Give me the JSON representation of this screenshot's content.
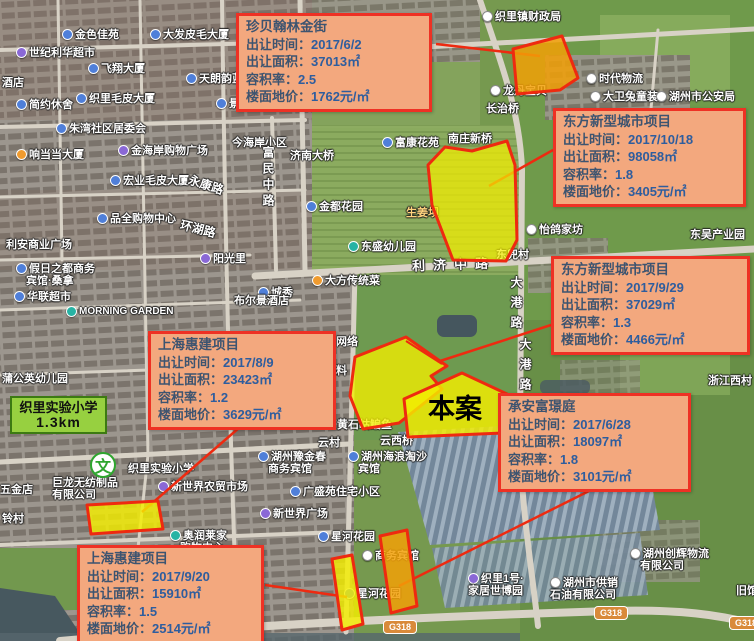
{
  "site_label": "本案",
  "school_badge": {
    "name": "织里实验小学",
    "distance": "1.3km"
  },
  "school_poi": {
    "glyph": "文"
  },
  "colors": {
    "callout_bg": "#f3a87e",
    "callout_border": "#ee3124",
    "callout_text": "#3d5470",
    "callout_value": "#2e5d9e",
    "parcel_yellow": "#f4ee00",
    "parcel_orange": "#f2a007",
    "parcel_stroke": "#ee2a10",
    "school_badge_bg": "#97d040"
  },
  "callouts": [
    {
      "name": "珍贝翰林金街",
      "x": 236,
      "y": 13,
      "w": 196,
      "h": 93,
      "rows": [
        {
          "label": "出让时间：",
          "value": "2017/6/2"
        },
        {
          "label": "出让面积：",
          "value": "37013㎡"
        },
        {
          "label": "容积率：",
          "value": "2.5"
        },
        {
          "label": "楼面地价：",
          "value": "1762元/㎡"
        }
      ]
    },
    {
      "name": "东方新型城市项目",
      "x": 553,
      "y": 108,
      "w": 193,
      "h": 95,
      "rows": [
        {
          "label": "出让时间：",
          "value": "2017/10/18"
        },
        {
          "label": "出让面积：",
          "value": "98058㎡"
        },
        {
          "label": "容积率：",
          "value": "1.8"
        },
        {
          "label": "楼面地价：",
          "value": "3405元/㎡"
        }
      ]
    },
    {
      "name": "东方新型城市项目",
      "x": 551,
      "y": 256,
      "w": 199,
      "h": 99,
      "rows": [
        {
          "label": "出让时间：",
          "value": "2017/9/29"
        },
        {
          "label": "出让面积：",
          "value": "37029㎡"
        },
        {
          "label": "容积率：",
          "value": "1.3"
        },
        {
          "label": "楼面地价：",
          "value": "4466元/㎡"
        }
      ]
    },
    {
      "name": "上海惠建项目",
      "x": 148,
      "y": 331,
      "w": 188,
      "h": 96,
      "rows": [
        {
          "label": "出让时间：",
          "value": "2017/8/9"
        },
        {
          "label": "出让面积：",
          "value": "23423㎡"
        },
        {
          "label": "容积率：",
          "value": "1.2"
        },
        {
          "label": "楼面地价：",
          "value": "3629元/㎡"
        }
      ]
    },
    {
      "name": "承安富璟庭",
      "x": 498,
      "y": 393,
      "w": 193,
      "h": 98,
      "rows": [
        {
          "label": "出让时间：",
          "value": "2017/6/28"
        },
        {
          "label": "出让面积：",
          "value": "18097㎡"
        },
        {
          "label": "容积率：",
          "value": "1.8"
        },
        {
          "label": "楼面地价：",
          "value": "3101元/㎡"
        }
      ]
    },
    {
      "name": "上海惠建项目",
      "x": 77,
      "y": 545,
      "w": 187,
      "h": 95,
      "rows": [
        {
          "label": "出让时间：",
          "value": "2017/9/20"
        },
        {
          "label": "出让面积：",
          "value": "15910㎡"
        },
        {
          "label": "容积率：",
          "value": "1.5"
        },
        {
          "label": "楼面地价：",
          "value": "2514元/㎡"
        }
      ]
    }
  ],
  "road_badges": [
    {
      "t": "G318",
      "x": 383,
      "y": 620
    },
    {
      "t": "G318",
      "x": 594,
      "y": 606
    },
    {
      "t": "G318",
      "x": 729,
      "y": 616
    }
  ],
  "map_labels": [
    {
      "t": "金色佳苑",
      "x": 62,
      "y": 26,
      "icon": "blue"
    },
    {
      "t": "大发皮毛大厦",
      "x": 150,
      "y": 26,
      "icon": "blue"
    },
    {
      "t": "世纪利华超市",
      "x": 16,
      "y": 44,
      "icon": "purple"
    },
    {
      "t": "飞翔大厦",
      "x": 88,
      "y": 60,
      "icon": "blue"
    },
    {
      "t": "天朗韵蓝城",
      "x": 186,
      "y": 70,
      "icon": "blue"
    },
    {
      "t": "酒店",
      "x": 2,
      "y": 74
    },
    {
      "t": "织里毛皮大厦",
      "x": 76,
      "y": 90,
      "icon": "blue"
    },
    {
      "t": "简约休舍",
      "x": 16,
      "y": 96,
      "icon": "blue"
    },
    {
      "t": "景",
      "x": 216,
      "y": 95,
      "icon": "blue"
    },
    {
      "t": "朱湾社区居委会",
      "x": 56,
      "y": 120,
      "icon": "blue"
    },
    {
      "t": "金海岸购物广场",
      "x": 118,
      "y": 142,
      "icon": "purple"
    },
    {
      "t": "今海岸小区",
      "x": 232,
      "y": 134
    },
    {
      "t": "响当当大厦",
      "x": 16,
      "y": 146,
      "icon": "orange"
    },
    {
      "t": "宏业毛皮大厦",
      "x": 110,
      "y": 172,
      "icon": "blue"
    },
    {
      "t": "永康路",
      "x": 188,
      "y": 176,
      "rot": 18,
      "sz": 12
    },
    {
      "t": "品全购物中心",
      "x": 97,
      "y": 210,
      "icon": "blue"
    },
    {
      "t": "环湖路",
      "x": 180,
      "y": 220,
      "rot": 14,
      "sz": 12
    },
    {
      "t": "利安商业广场",
      "x": 6,
      "y": 236
    },
    {
      "t": "阳光里",
      "x": 200,
      "y": 250,
      "icon": "purple"
    },
    {
      "t": "假日之都商务",
      "x": 16,
      "y": 260,
      "icon": "blue"
    },
    {
      "t": "宾馆·桑拿",
      "x": 26,
      "y": 272
    },
    {
      "t": "华联超市",
      "x": 14,
      "y": 288,
      "icon": "blue"
    },
    {
      "t": "MORNING GARDEN",
      "x": 66,
      "y": 306,
      "icon": "teal",
      "sz": 10
    },
    {
      "t": "蒲公英幼儿园",
      "x": 2,
      "y": 370
    },
    {
      "t": "济南大桥",
      "x": 290,
      "y": 147
    },
    {
      "t": "富民中路",
      "x": 260,
      "y": 146,
      "v": 1,
      "ls": 4,
      "sz": 12
    },
    {
      "t": "富康花苑",
      "x": 382,
      "y": 134,
      "icon": "blue"
    },
    {
      "t": "南庄新桥",
      "x": 448,
      "y": 130
    },
    {
      "t": "金都花园",
      "x": 306,
      "y": 198,
      "icon": "blue"
    },
    {
      "t": "生姜坝",
      "x": 406,
      "y": 204,
      "color": "#ffd37e"
    },
    {
      "t": "东盛幼儿园",
      "x": 348,
      "y": 238,
      "icon": "teal"
    },
    {
      "t": "利济中路",
      "x": 412,
      "y": 254,
      "ls": 8,
      "sz": 13,
      "rot": -2
    },
    {
      "t": "大方传统菜",
      "x": 312,
      "y": 272,
      "icon": "orange"
    },
    {
      "t": "城秀",
      "x": 258,
      "y": 284,
      "icon": "blue"
    },
    {
      "t": "布尔景酒店",
      "x": 234,
      "y": 292
    },
    {
      "t": "网络",
      "x": 336,
      "y": 333
    },
    {
      "t": "料",
      "x": 336,
      "y": 362
    },
    {
      "t": "黄石岵鳊鱼",
      "x": 337,
      "y": 416
    },
    {
      "t": "云村",
      "x": 318,
      "y": 434
    },
    {
      "t": "云西桥",
      "x": 380,
      "y": 432
    },
    {
      "t": "湖州豫金春",
      "x": 258,
      "y": 448,
      "icon": "blue"
    },
    {
      "t": "商务宾馆",
      "x": 268,
      "y": 460
    },
    {
      "t": "湖州海浪淘沙",
      "x": 348,
      "y": 448,
      "icon": "blue"
    },
    {
      "t": "宾馆",
      "x": 358,
      "y": 460
    },
    {
      "t": "广盛苑住宅小区",
      "x": 290,
      "y": 483,
      "icon": "blue"
    },
    {
      "t": "新世界广场",
      "x": 260,
      "y": 505,
      "icon": "purple"
    },
    {
      "t": "星河花园",
      "x": 318,
      "y": 528,
      "icon": "blue"
    },
    {
      "t": "商务宾馆",
      "x": 362,
      "y": 547,
      "icon": "white"
    },
    {
      "t": "星河花园",
      "x": 344,
      "y": 585,
      "icon": "blue"
    },
    {
      "t": "织里1号·",
      "x": 468,
      "y": 570,
      "icon": "purple"
    },
    {
      "t": "家居世博园",
      "x": 468,
      "y": 582
    },
    {
      "t": "奥润莱家",
      "x": 170,
      "y": 527,
      "icon": "teal"
    },
    {
      "t": "购物中心",
      "x": 180,
      "y": 539
    },
    {
      "t": "新世界农贸市场",
      "x": 158,
      "y": 478,
      "icon": "purple"
    },
    {
      "t": "织里实验小学",
      "x": 128,
      "y": 460
    },
    {
      "t": "巨龙无纺制品",
      "x": 52,
      "y": 474
    },
    {
      "t": "有限公司",
      "x": 52,
      "y": 486
    },
    {
      "t": "五金店",
      "x": 0,
      "y": 481
    },
    {
      "t": "铃村",
      "x": 2,
      "y": 510
    },
    {
      "t": "织里镇财政局",
      "x": 482,
      "y": 8,
      "icon": "white"
    },
    {
      "t": "时代物流",
      "x": 586,
      "y": 70,
      "icon": "white"
    },
    {
      "t": "龙丹宝贝",
      "x": 490,
      "y": 82,
      "icon": "white"
    },
    {
      "t": "大卫兔童装",
      "x": 590,
      "y": 88,
      "icon": "white"
    },
    {
      "t": "湖州市公安局",
      "x": 656,
      "y": 88,
      "icon": "white"
    },
    {
      "t": "长治桥",
      "x": 486,
      "y": 100
    },
    {
      "t": "怡鸽家坊",
      "x": 526,
      "y": 221,
      "icon": "white"
    },
    {
      "t": "东吴产业园",
      "x": 690,
      "y": 226
    },
    {
      "t": "东兜村",
      "x": 496,
      "y": 246
    },
    {
      "t": "大港路",
      "x": 508,
      "y": 276,
      "v": 1,
      "ls": 8,
      "sz": 12
    },
    {
      "t": "大港路",
      "x": 517,
      "y": 338,
      "v": 1,
      "ls": 8,
      "sz": 12
    },
    {
      "t": "浙江西村",
      "x": 708,
      "y": 372
    },
    {
      "t": "湖州创辉物流",
      "x": 630,
      "y": 545,
      "icon": "white"
    },
    {
      "t": "有限公司",
      "x": 640,
      "y": 557
    },
    {
      "t": "湖州市供销",
      "x": 550,
      "y": 574,
      "icon": "white"
    },
    {
      "t": "石油有限公司",
      "x": 550,
      "y": 586
    },
    {
      "t": "旧馆",
      "x": 736,
      "y": 582
    }
  ]
}
